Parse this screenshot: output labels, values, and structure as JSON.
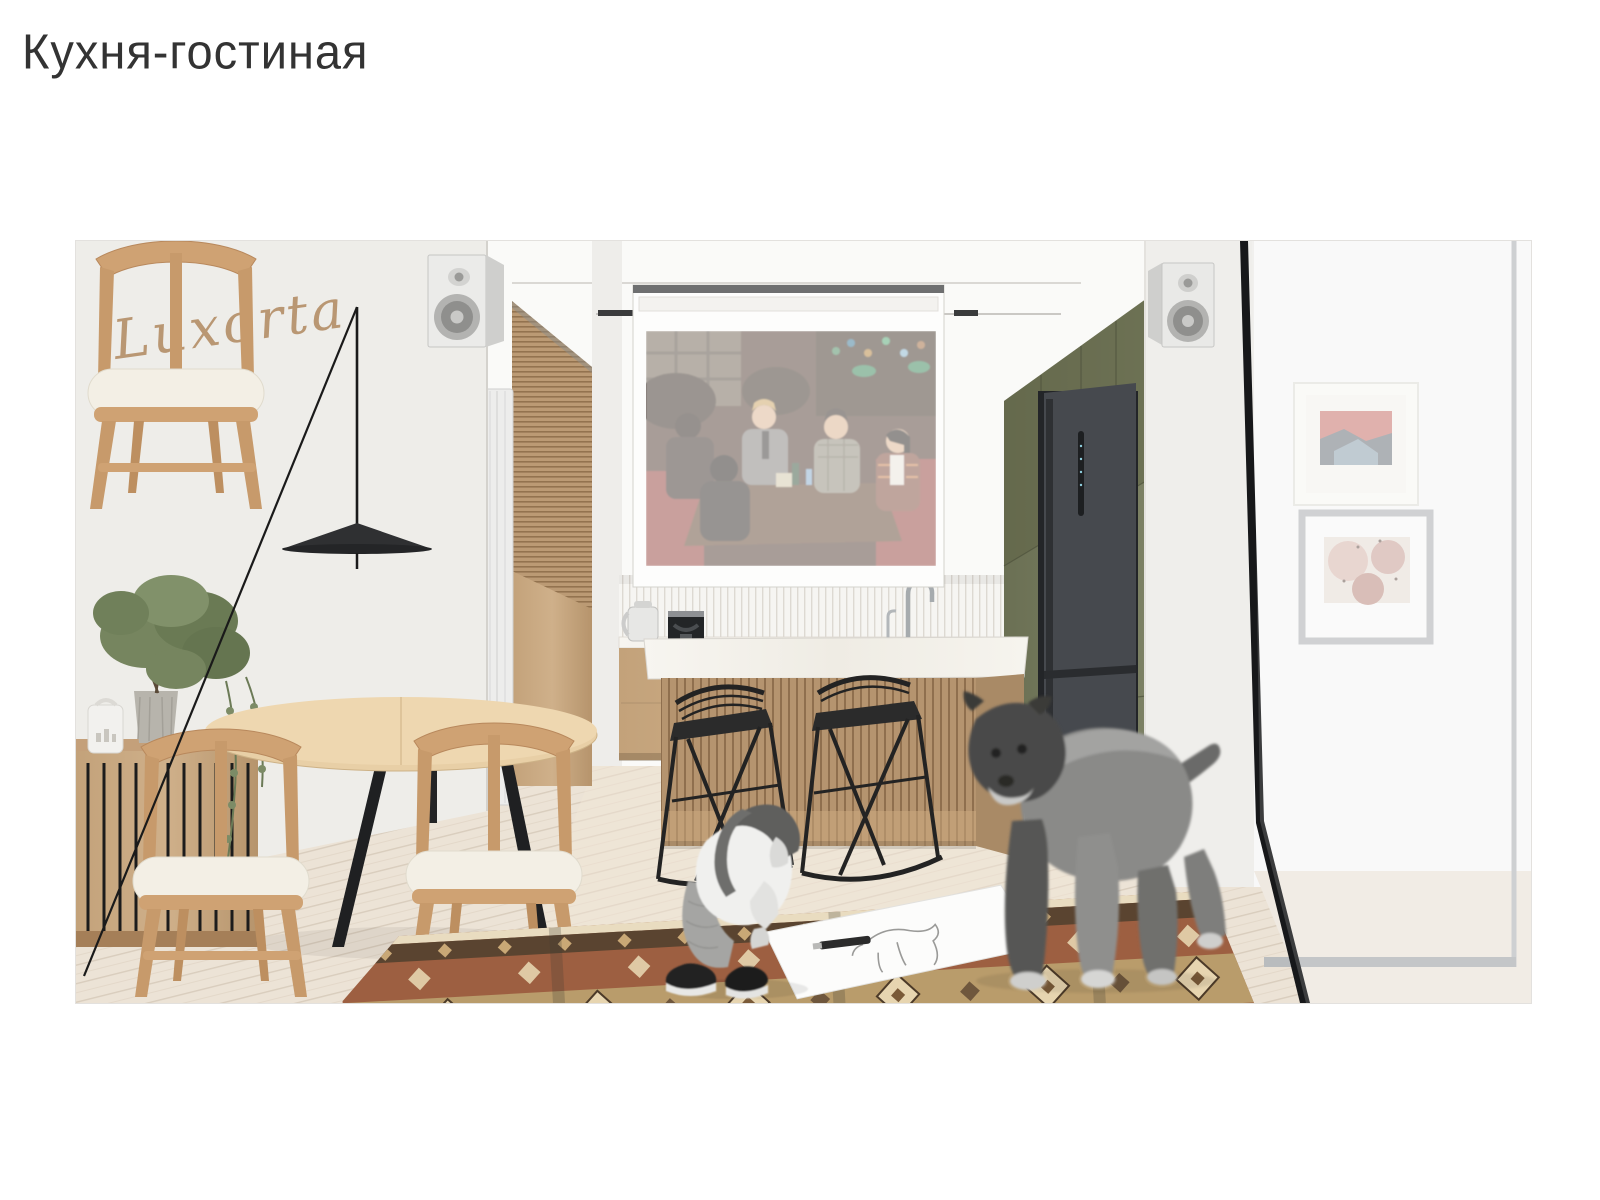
{
  "page": {
    "title": "Кухня-гостиная"
  },
  "watermark": {
    "text": "Luxorta"
  },
  "scene": {
    "description": "interior design visualization of a kitchen-living room",
    "tv_scene": "group of friends sitting at a pub table (sitcom still) on a translucent projection screen",
    "objects": [
      "floor-lamp",
      "dining-table",
      "dining-chair",
      "sideboard",
      "potted-olive-tree",
      "aroma-diffuser",
      "vertical-radiator",
      "wood-slat-panel",
      "projection-screen",
      "track-light",
      "kitchen-island",
      "bar-stool",
      "kettle",
      "coffee-machine",
      "faucet",
      "farmhouse-sink",
      "tall-olive-cabinets",
      "built-in-fridge",
      "studio-monitor-speaker",
      "framed-art-red-landscape",
      "framed-art-pink-abstract",
      "glass-partition",
      "kilim-rug",
      "child-drawing",
      "dog",
      "sketch-paper"
    ]
  },
  "colors": {
    "title_text": "#333333",
    "watermark_gold": "#b5906a",
    "wall_white": "#f2f1ee",
    "right_wall_white": "#f8f8f8",
    "wood_light": "#c9ab85",
    "wood_medium": "#b08a63",
    "olive_cabinet": "#767a5e",
    "olive_dark": "#606547",
    "fridge_gray": "#46494e",
    "counter_white": "#f4f2ec",
    "floor_wood": "#ece3d6",
    "rug_rust": "#9d5f41",
    "rug_beige": "#b99c6b",
    "rug_brown": "#5a4430",
    "rug_cream": "#e7d5b0",
    "stool_black": "#2b2b2b",
    "lamp_black": "#1f2022",
    "frame_border": "#e3e1de"
  }
}
